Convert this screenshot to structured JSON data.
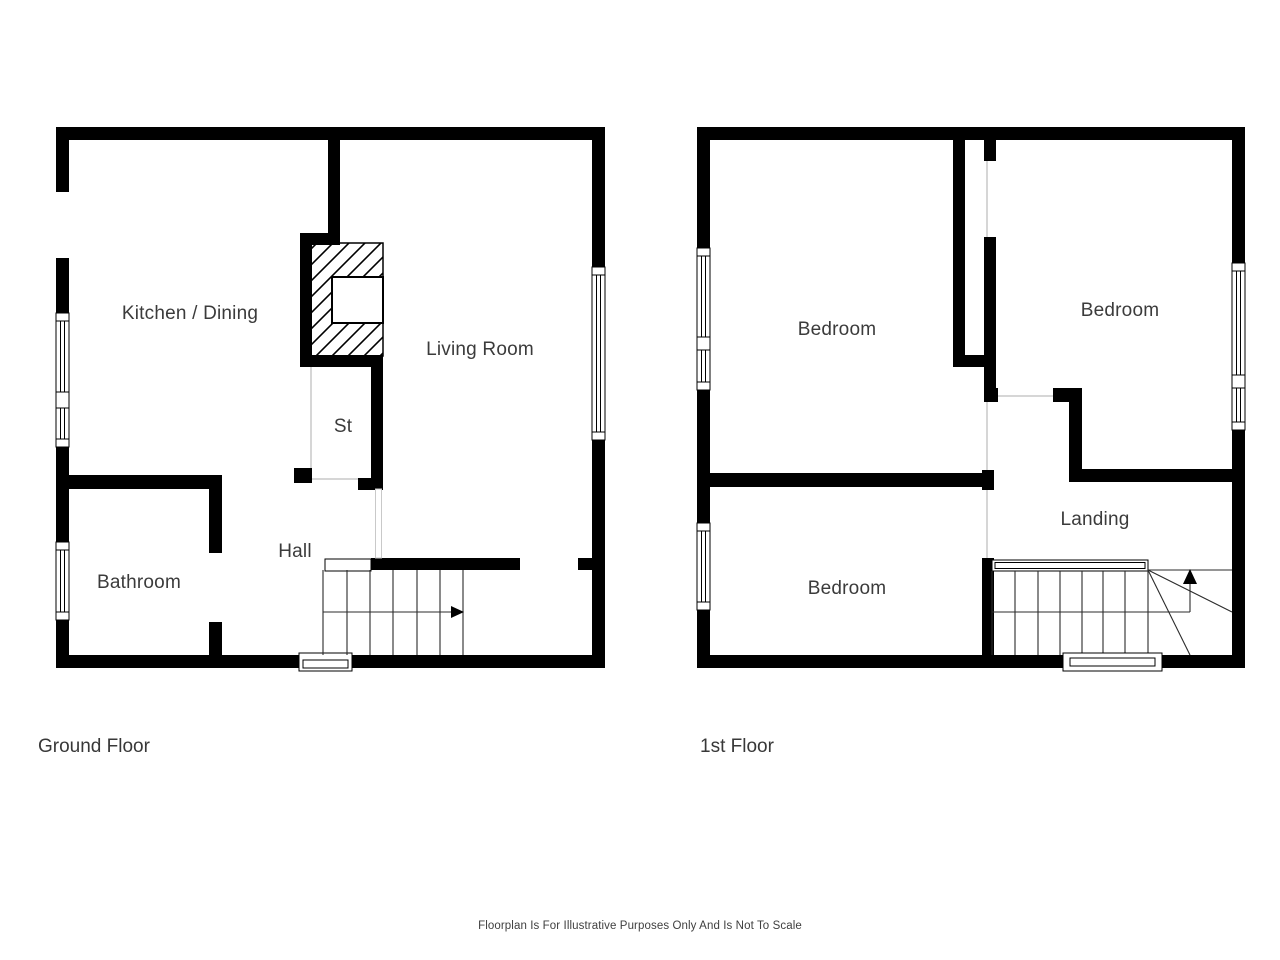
{
  "ground_floor": {
    "title": "Ground Floor",
    "rooms": {
      "kitchen_dining": "Kitchen / Dining",
      "living_room": "Living Room",
      "storage": "St",
      "hall": "Hall",
      "bathroom": "Bathroom"
    }
  },
  "first_floor": {
    "title": "1st Floor",
    "rooms": {
      "bedroom_front": "Bedroom",
      "bedroom_back": "Bedroom",
      "bedroom_third": "Bedroom",
      "landing": "Landing"
    }
  },
  "disclaimer": "Floorplan Is For Illustrative Purposes Only And Is Not To Scale",
  "colors": {
    "wall": "#000000",
    "text": "#3b3b3b",
    "tread_line": "#2b2b2b",
    "door_opening_line": "#c9c9c9",
    "background": "#ffffff"
  }
}
